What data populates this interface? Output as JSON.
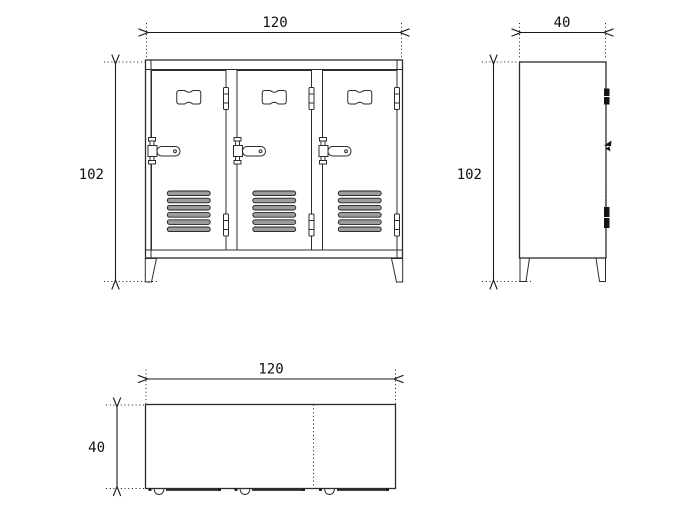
{
  "drawing": {
    "subject": "Dimension drawing of a three-door locker cabinet: front view, side view and plan view",
    "door_count": 3,
    "vent_slats_per_door": 6,
    "colors": {
      "line": "#2d2d2d",
      "dimension_line": "#1a1a1a",
      "vent_fill": "#9c9c9c",
      "hardware_dark": "#151515",
      "background": "#ffffff"
    },
    "dimensions": {
      "front_width": "120",
      "front_height": "102",
      "side_depth": "40",
      "side_height": "102",
      "plan_width": "120",
      "plan_depth": "40"
    }
  }
}
